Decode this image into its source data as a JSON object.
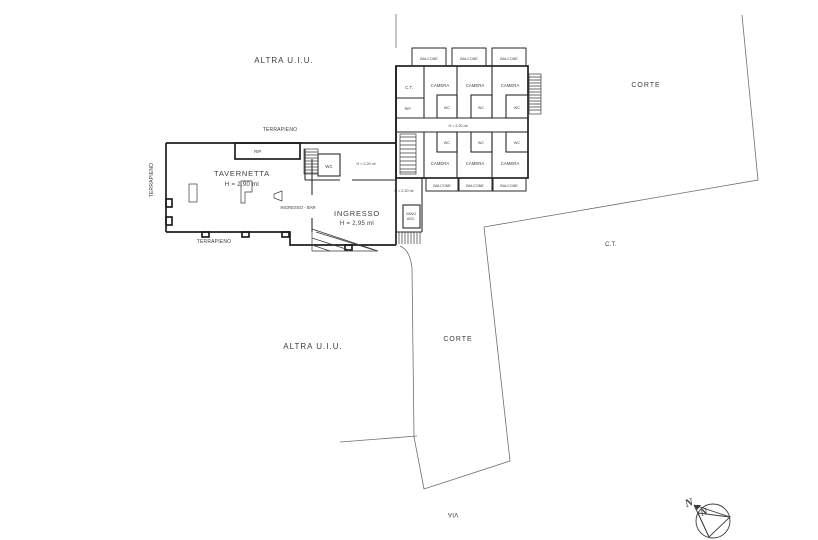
{
  "labels": {
    "altra_uiu": "ALTRA U.I.U.",
    "terrapieno": "TERRAPIENO",
    "tavernetta": "TAVERNETTA",
    "tavernetta_height": "H = 2,90 ml",
    "ingresso": "INGRESSO",
    "ingresso_height": "H = 2,95 ml",
    "ingresso_bar": "INGRESSO - BAR",
    "rip": "RIP.",
    "wc": "WC",
    "camera": "CAMERA",
    "balcone": "BALCONE",
    "ct": "C.T.",
    "vano_line1": "VANO",
    "vano_line2": "ASC.",
    "h_220": "H = 2,20 ml",
    "corte": "CORTE",
    "via": "VIA",
    "north": "N"
  },
  "colors": {
    "background": "#ffffff",
    "wall": "#1f1f1f",
    "partition": "#2a2a2a",
    "fixture": "#3a3a3a",
    "boundary": "#6e6e6e",
    "text": "#3d3d3d"
  }
}
